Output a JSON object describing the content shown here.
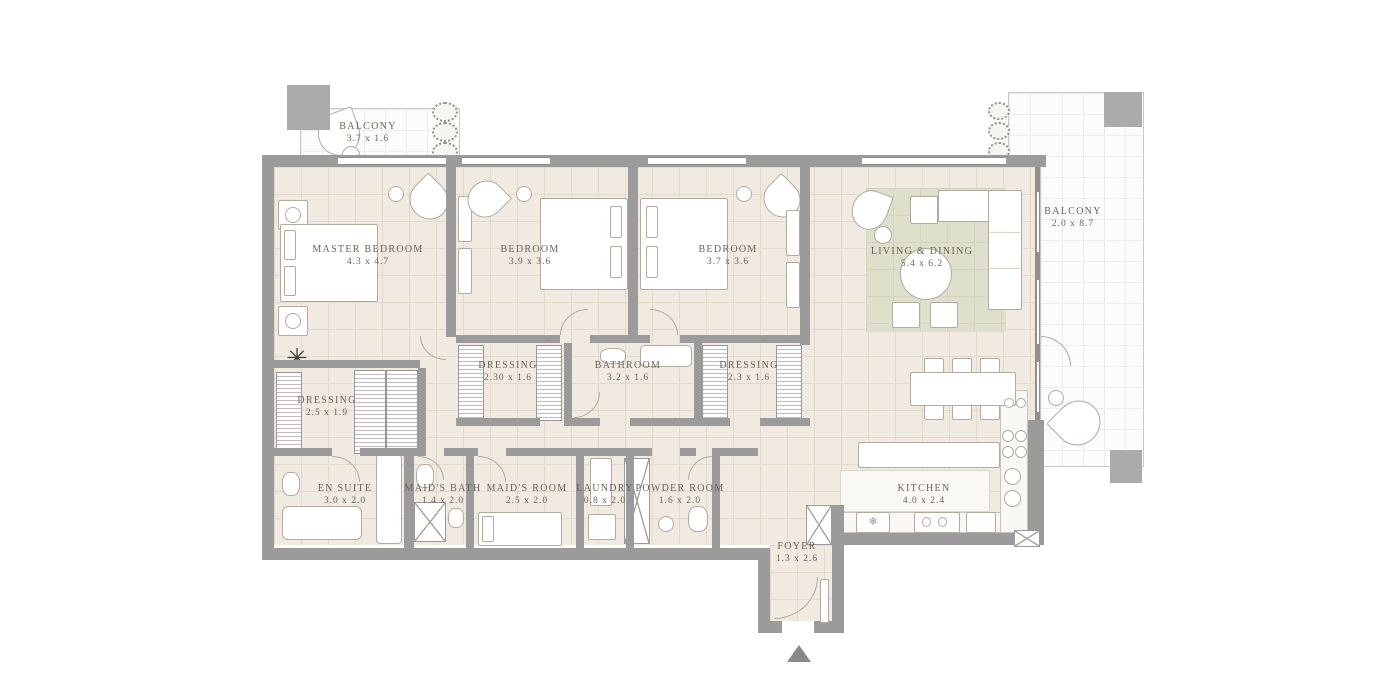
{
  "rooms": {
    "balcony_top": {
      "name": "BALCONY",
      "dims": "3.7 x 1.6"
    },
    "master_bedroom": {
      "name": "MASTER BEDROOM",
      "dims": "4.3 x 4.7"
    },
    "bedroom_a": {
      "name": "BEDROOM",
      "dims": "3.9 x 3.6"
    },
    "bedroom_b": {
      "name": "BEDROOM",
      "dims": "3.7 x 3.6"
    },
    "living_dining": {
      "name": "LIVING & DINING",
      "dims": "5.4 x 6.2"
    },
    "balcony_right": {
      "name": "BALCONY",
      "dims": "2.0 x 8.7"
    },
    "dressing_master": {
      "name": "DRESSING",
      "dims": "2.5 x 1.9"
    },
    "dressing_a": {
      "name": "DRESSING",
      "dims": "2.30 x 1.6"
    },
    "bathroom": {
      "name": "BATHROOM",
      "dims": "3.2 x 1.6"
    },
    "dressing_b": {
      "name": "DRESSING",
      "dims": "2.3 x 1.6"
    },
    "en_suite": {
      "name": "EN SUITE",
      "dims": "3.0 x 2.0"
    },
    "maids_bath": {
      "name": "MAID'S BATH",
      "dims": "1.4 x 2.0"
    },
    "maids_room": {
      "name": "MAID'S ROOM",
      "dims": "2.5 x 2.0"
    },
    "laundry": {
      "name": "LAUNDRY",
      "dims": "0.8 x 2.0"
    },
    "powder_room": {
      "name": "POWDER ROOM",
      "dims": "1.6 x 2.0"
    },
    "kitchen": {
      "name": "KITCHEN",
      "dims": "4.0 x 2.4"
    },
    "foyer": {
      "name": "FOYER",
      "dims": "1.3 x 2.6"
    }
  },
  "icons": {
    "palm_plant_icon": "✳",
    "freezer_icon": "❄"
  },
  "colors": {
    "wall": "#9b9b9b",
    "column": "#ababab",
    "floor": "#f0eae1",
    "floor_grid": "#e3dacb",
    "balcony": "#fcfcfc",
    "rug": "#dfe0cc",
    "label_text": "#6b6359",
    "furniture_line": "#b2aba0",
    "entrance_arrow": "#8a8a8a"
  }
}
